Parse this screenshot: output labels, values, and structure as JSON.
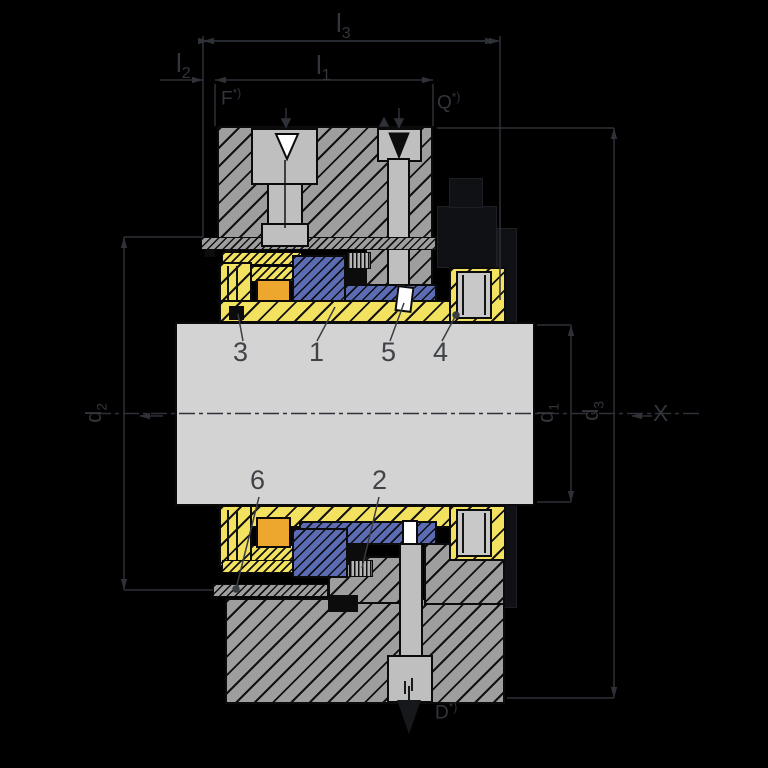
{
  "drawing_type": "mechanical-seal-cross-section",
  "colors": {
    "background": "#000000",
    "housing_gray": "#9e9e9e",
    "shaft_gray": "#d3d3d3",
    "sleeve_yellow": "#f2e25f",
    "rotor_blue": "#5c6cb2",
    "spring_orange": "#eda72e",
    "bore_gray": "#bfbfbf",
    "line": "#2e3138",
    "label": "#3f4247"
  },
  "dimensions": {
    "l3": {
      "base": "l",
      "sub": "3"
    },
    "l2": {
      "base": "l",
      "sub": "2"
    },
    "l1": {
      "base": "l",
      "sub": "1"
    },
    "d2": {
      "base": "d",
      "sub": "2"
    },
    "d1": {
      "base": "d",
      "sub": "1"
    },
    "d3": {
      "base": "d",
      "sub": "3"
    },
    "view_x": "X"
  },
  "ports": {
    "flush": {
      "letter": "F",
      "note": "*)"
    },
    "quench": {
      "letter": "Q",
      "note": "*)"
    },
    "drain": {
      "letter": "D",
      "note": "*)"
    }
  },
  "parts": {
    "p1": "1",
    "p2": "2",
    "p3": "3",
    "p4": "4",
    "p5": "5",
    "p6": "6"
  }
}
